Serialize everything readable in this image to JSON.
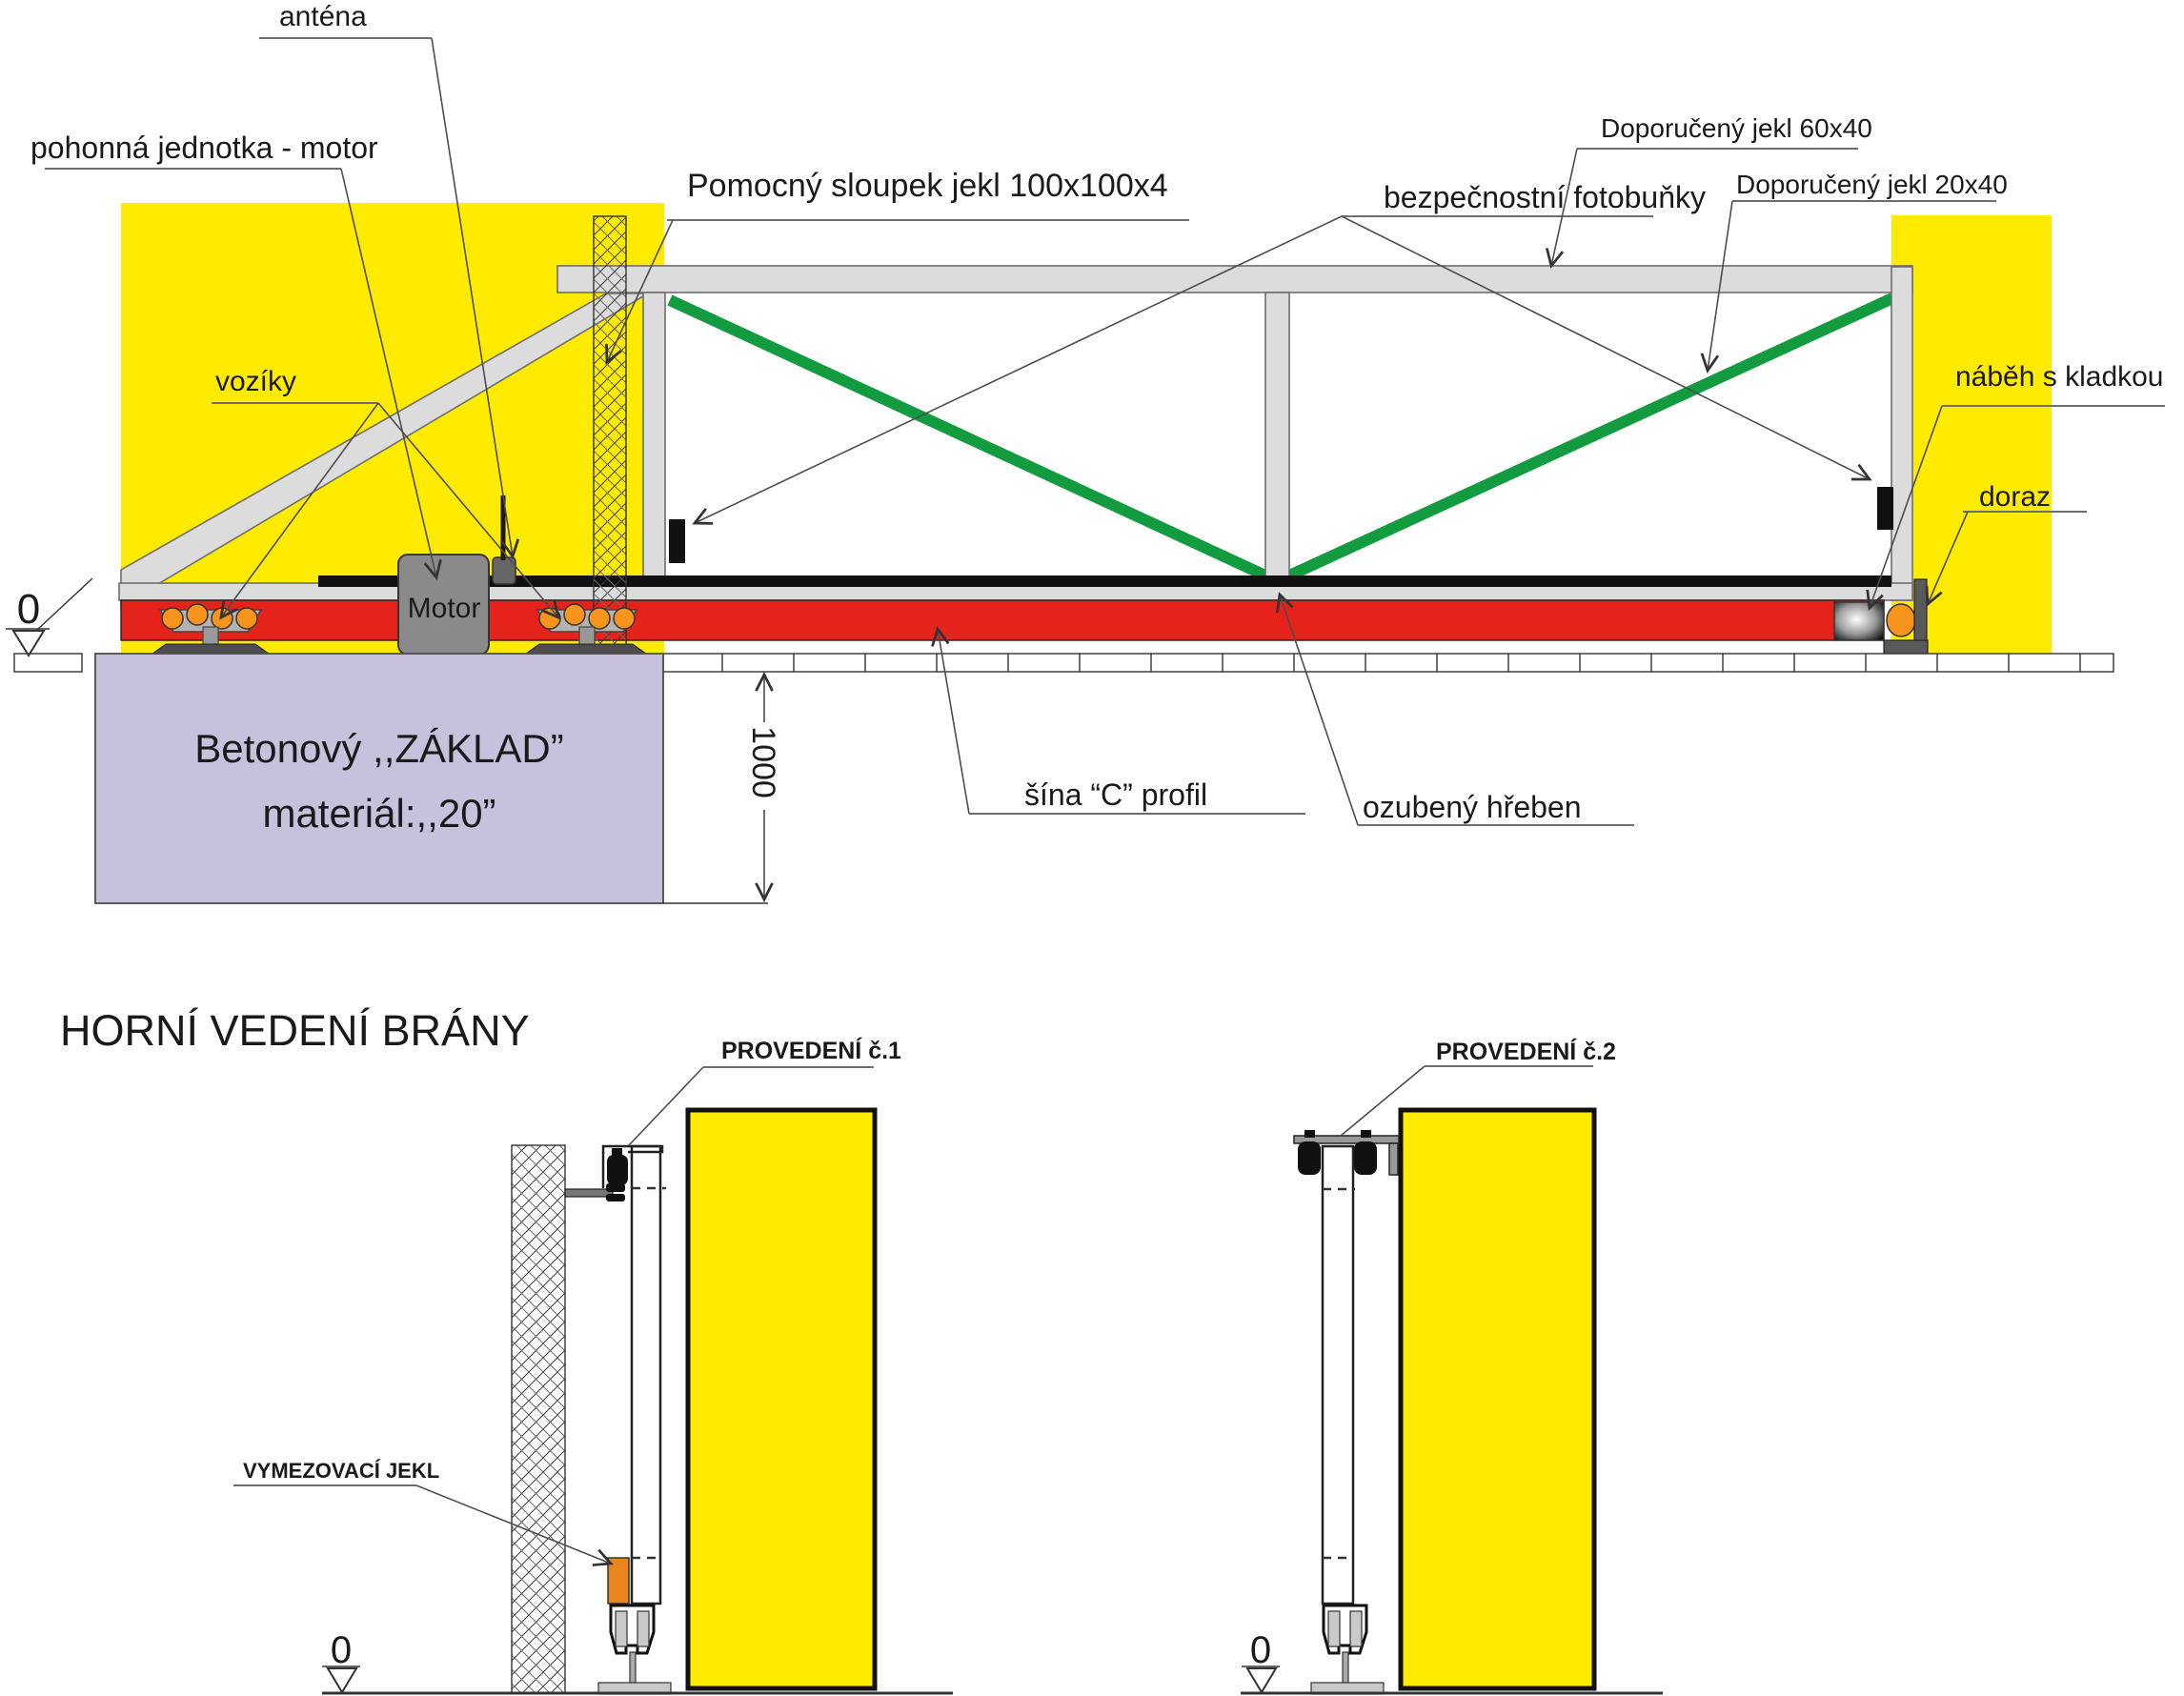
{
  "colors": {
    "wall_yellow": "#FFEB00",
    "rail_red": "#E5231B",
    "diagonal_green": "#129B3F",
    "frame_gray": "#DCDCDC",
    "foundation_lavender": "#C7C1DD",
    "roller_orange": "#F7941D",
    "jekl_orange": "#E8831E",
    "motor_gray": "#8A8A8A",
    "hardware_dark": "#595959"
  },
  "top_view": {
    "labels": {
      "antena": "anténa",
      "pohonna": "pohonná jednotka - motor",
      "pomocny": "Pomocný sloupek jekl 100x100x4",
      "fotobunky": "bezpečnostní fotobuňky",
      "jekl60": "Doporučený jekl 60x40",
      "jekl20": "Doporučený jekl 20x40",
      "nabeh": "náběh s kladkou",
      "doraz": "doraz",
      "voziky": "vozíky",
      "motor": "Motor",
      "sina": "šína “C” profil",
      "ozubeny": "ozubený hřeben"
    },
    "foundation": {
      "line1": "Betonový ,,ZÁKLAD”",
      "line2": "materiál:,,20”",
      "depth_dim": "1000"
    },
    "datum_zero": "0"
  },
  "bottom_view": {
    "title": "HORNÍ VEDENÍ BRÁNY",
    "labels": {
      "prov1": "PROVEDENÍ č.1",
      "prov2": "PROVEDENÍ č.2",
      "vymezovaci": "VYMEZOVACÍ JEKL"
    },
    "datum_zero_1": "0",
    "datum_zero_2": "0"
  }
}
